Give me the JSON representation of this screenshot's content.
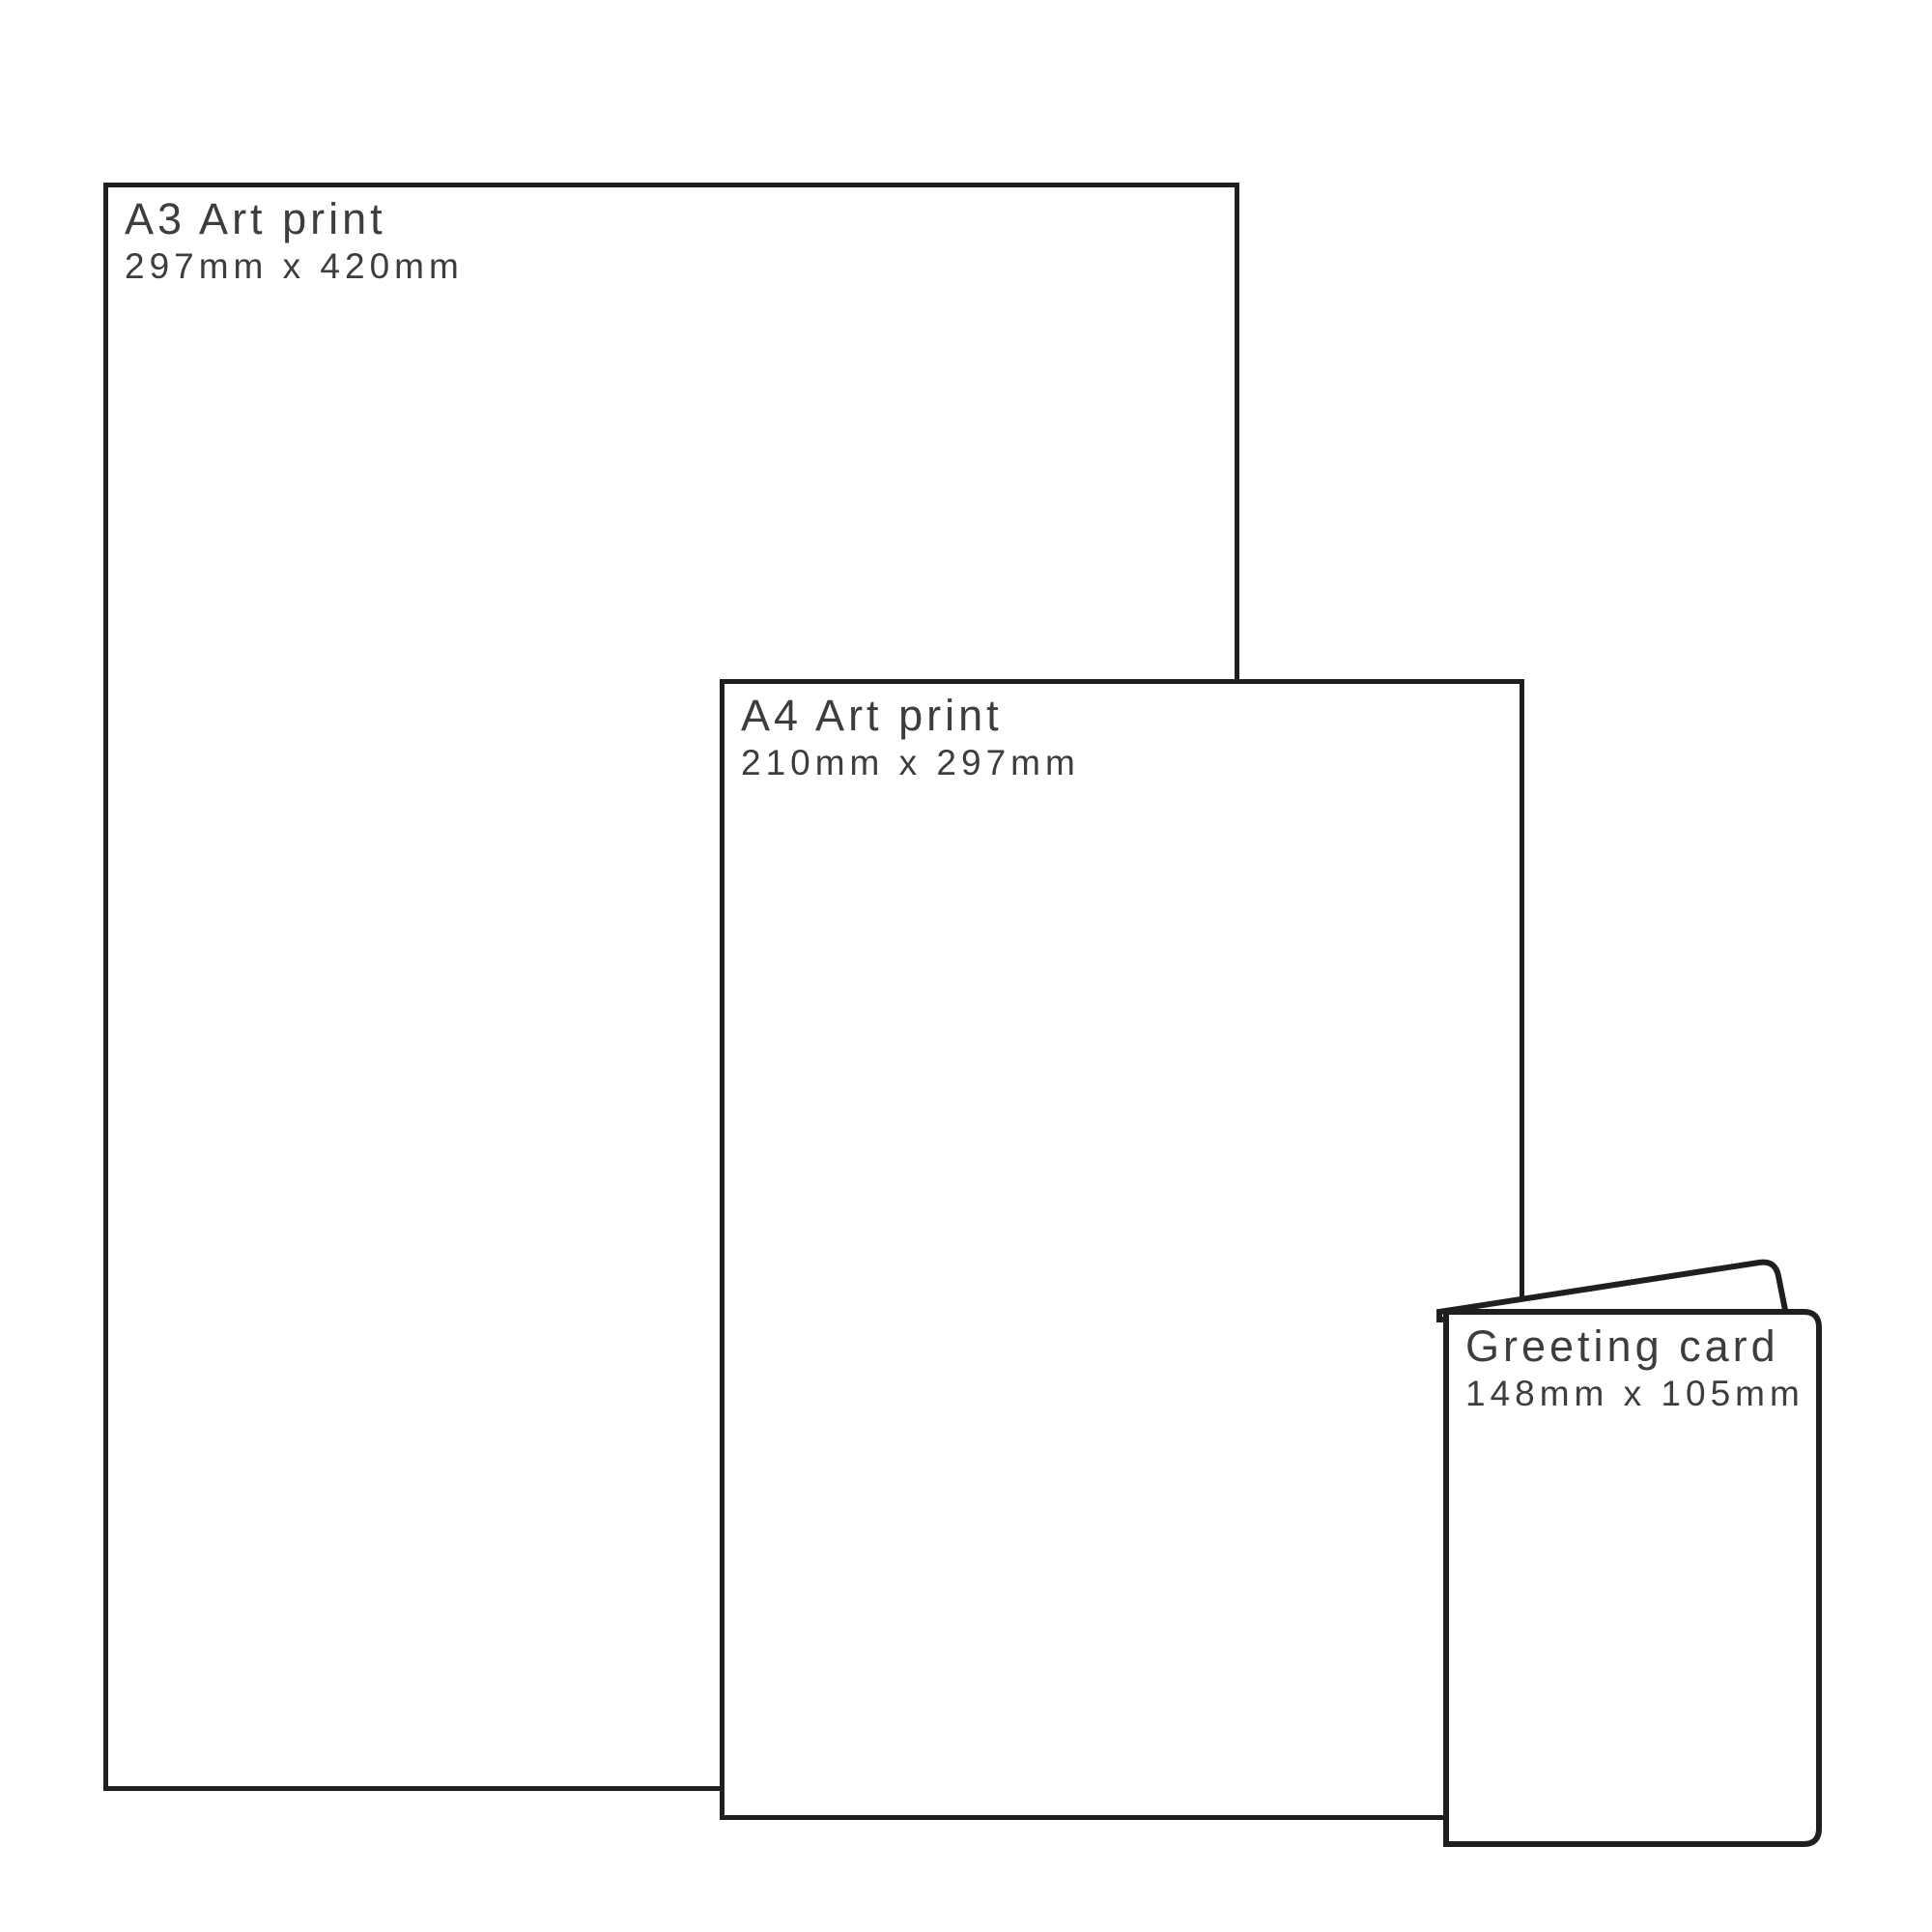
{
  "page": {
    "background_color": "#ffffff",
    "outline_color": "#1f1f1f",
    "text_color": "#3d3d3d"
  },
  "products": [
    {
      "title": "A3 Art print",
      "dimensions": "297mm x 420mm"
    },
    {
      "title": "A4 Art print",
      "dimensions": "210mm x 297mm"
    },
    {
      "title": "Greeting card",
      "dimensions": "148mm x 105mm"
    }
  ]
}
